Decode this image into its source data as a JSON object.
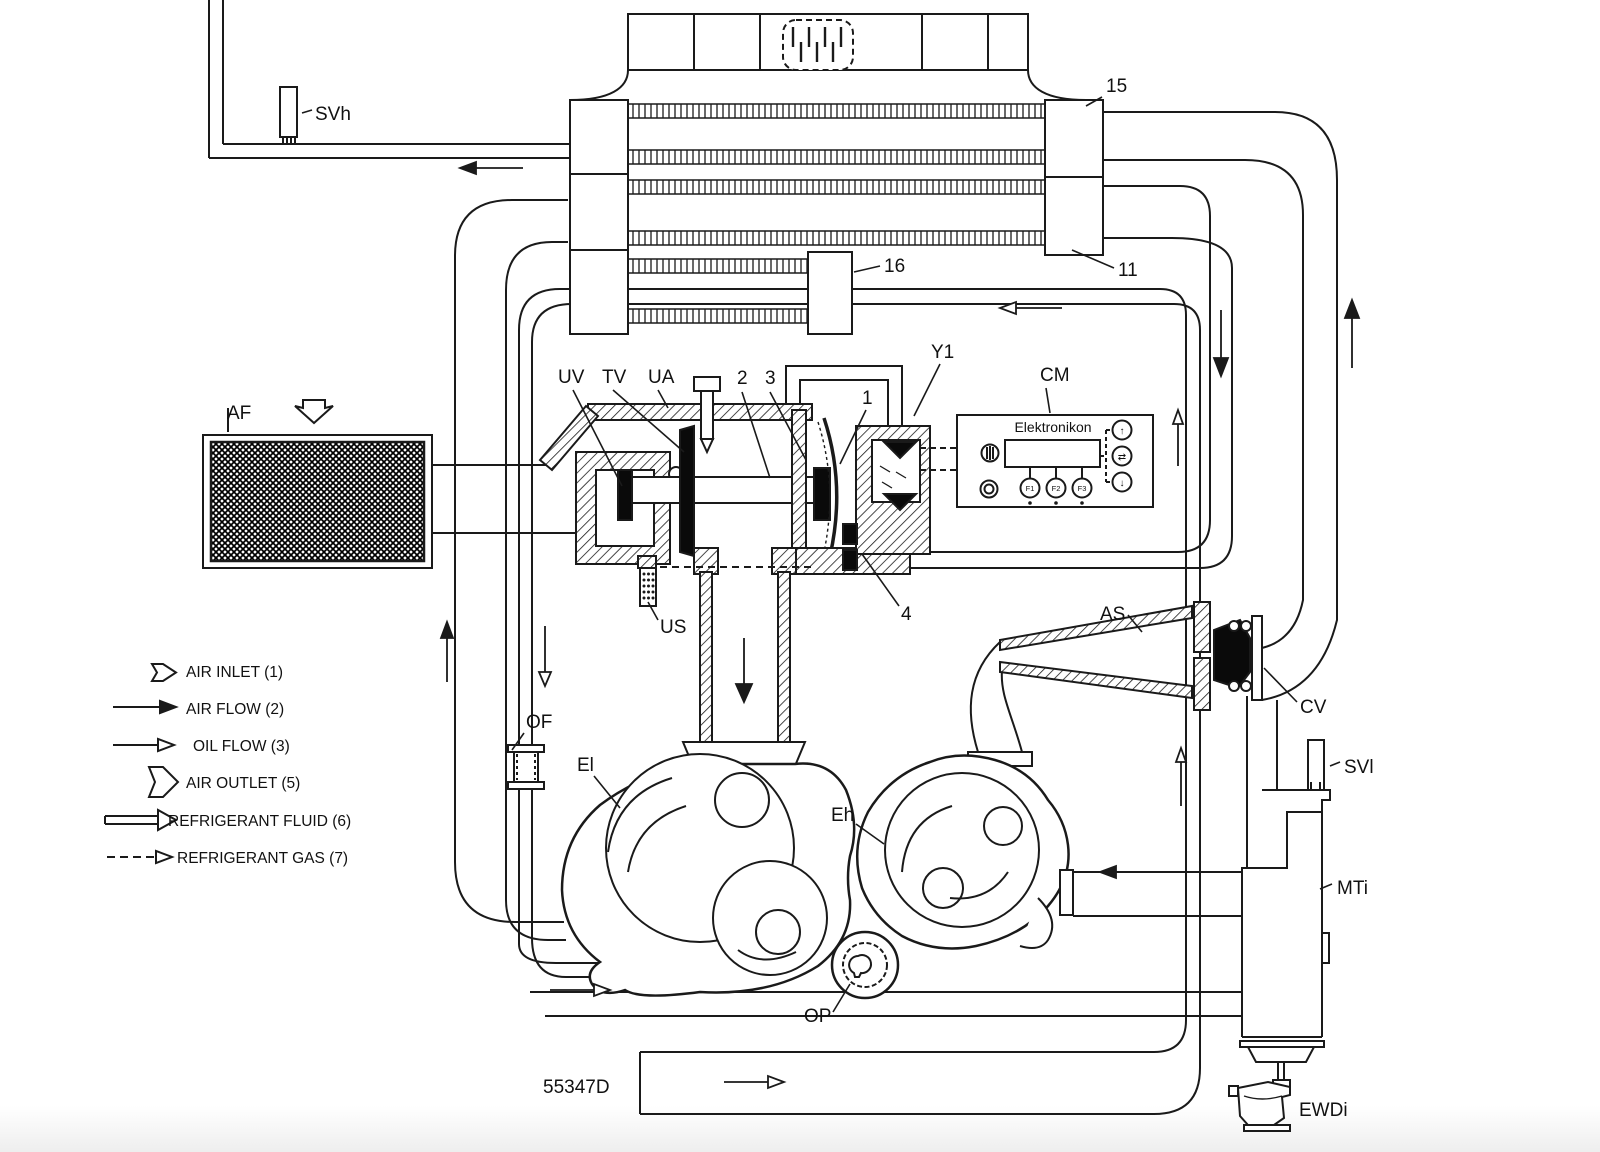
{
  "diagram": {
    "drawing_number": "55347D",
    "type": "compressor air/oil flow schematic",
    "colors": {
      "line": "#1a1a1a",
      "fill_black": "#0a0a0a",
      "background": "#ffffff"
    },
    "labels": [
      {
        "id": "label-svh",
        "text": "SVh",
        "x": 315,
        "y": 120,
        "size": 19
      },
      {
        "id": "label-15",
        "text": "15",
        "x": 1106,
        "y": 92,
        "size": 19
      },
      {
        "id": "label-11",
        "text": "11",
        "x": 1118,
        "y": 276,
        "size": 19
      },
      {
        "id": "label-16",
        "text": "16",
        "x": 884,
        "y": 272,
        "size": 19
      },
      {
        "id": "label-uv",
        "text": "UV",
        "x": 558,
        "y": 383,
        "size": 19
      },
      {
        "id": "label-tv",
        "text": "TV",
        "x": 602,
        "y": 383,
        "size": 19
      },
      {
        "id": "label-ua",
        "text": "UA",
        "x": 648,
        "y": 383,
        "size": 19
      },
      {
        "id": "label-2",
        "text": "2",
        "x": 737,
        "y": 384,
        "size": 19
      },
      {
        "id": "label-3",
        "text": "3",
        "x": 765,
        "y": 384,
        "size": 19
      },
      {
        "id": "label-1",
        "text": "1",
        "x": 862,
        "y": 404,
        "size": 19
      },
      {
        "id": "label-y1",
        "text": "Y1",
        "x": 931,
        "y": 358,
        "size": 19
      },
      {
        "id": "label-cm",
        "text": "CM",
        "x": 1040,
        "y": 381,
        "size": 19
      },
      {
        "id": "label-4",
        "text": "4",
        "x": 901,
        "y": 620,
        "size": 19
      },
      {
        "id": "label-us",
        "text": "US",
        "x": 660,
        "y": 633,
        "size": 19
      },
      {
        "id": "label-af",
        "text": "AF",
        "x": 227,
        "y": 419,
        "size": 19
      },
      {
        "id": "label-as",
        "text": "AS",
        "x": 1100,
        "y": 620,
        "size": 19
      },
      {
        "id": "label-cv",
        "text": "CV",
        "x": 1300,
        "y": 713,
        "size": 19
      },
      {
        "id": "label-svl",
        "text": "SVl",
        "x": 1344,
        "y": 773,
        "size": 19
      },
      {
        "id": "label-mti",
        "text": "MTi",
        "x": 1337,
        "y": 894,
        "size": 19
      },
      {
        "id": "label-of",
        "text": "OF",
        "x": 526,
        "y": 728,
        "size": 19
      },
      {
        "id": "label-el",
        "text": "El",
        "x": 577,
        "y": 771,
        "size": 19
      },
      {
        "id": "label-eh",
        "text": "Eh",
        "x": 831,
        "y": 821,
        "size": 19
      },
      {
        "id": "label-op",
        "text": "OP",
        "x": 804,
        "y": 1022,
        "size": 19
      },
      {
        "id": "label-ewdi",
        "text": "EWDi",
        "x": 1299,
        "y": 1116,
        "size": 19
      },
      {
        "id": "drawing-number",
        "text": "55347D",
        "x": 543,
        "y": 1093,
        "size": 19
      }
    ],
    "control_panel": {
      "title": "Elektronikon",
      "title_x": 1053,
      "title_y": 432,
      "buttons": [
        {
          "id": "btn-f1",
          "text": "F1",
          "x": 1030,
          "y": 491
        },
        {
          "id": "btn-f2",
          "text": "F2",
          "x": 1056,
          "y": 491
        },
        {
          "id": "btn-f3",
          "text": "F3",
          "x": 1082,
          "y": 491
        }
      ],
      "indicators": [
        {
          "id": "ind-up",
          "text": "↑",
          "x": 1122,
          "y": 434
        },
        {
          "id": "ind-auto",
          "text": "⇄",
          "x": 1122,
          "y": 460
        },
        {
          "id": "ind-down",
          "text": "↓",
          "x": 1122,
          "y": 486
        }
      ]
    },
    "legend": [
      {
        "id": "legend-air-inlet",
        "symbol": "hollow-pentagon-arrow-small",
        "text": "AIR INLET (1)",
        "x": 186,
        "y": 677
      },
      {
        "id": "legend-air-flow",
        "symbol": "solid-arrow",
        "text": "AIR FLOW (2)",
        "x": 186,
        "y": 714
      },
      {
        "id": "legend-oil-flow",
        "symbol": "open-arrow",
        "text": "OIL FLOW (3)",
        "x": 193,
        "y": 751
      },
      {
        "id": "legend-air-outlet",
        "symbol": "hollow-pentagon-arrow-large",
        "text": "AIR OUTLET (5)",
        "x": 186,
        "y": 788
      },
      {
        "id": "legend-refrigerant-fluid",
        "symbol": "double-line-open-arrow",
        "text": "REFRIGERANT FLUID (6)",
        "x": 168,
        "y": 826
      },
      {
        "id": "legend-refrigerant-gas",
        "symbol": "dashed-open-arrow",
        "text": "REFRIGERANT GAS (7)",
        "x": 177,
        "y": 863
      }
    ]
  }
}
